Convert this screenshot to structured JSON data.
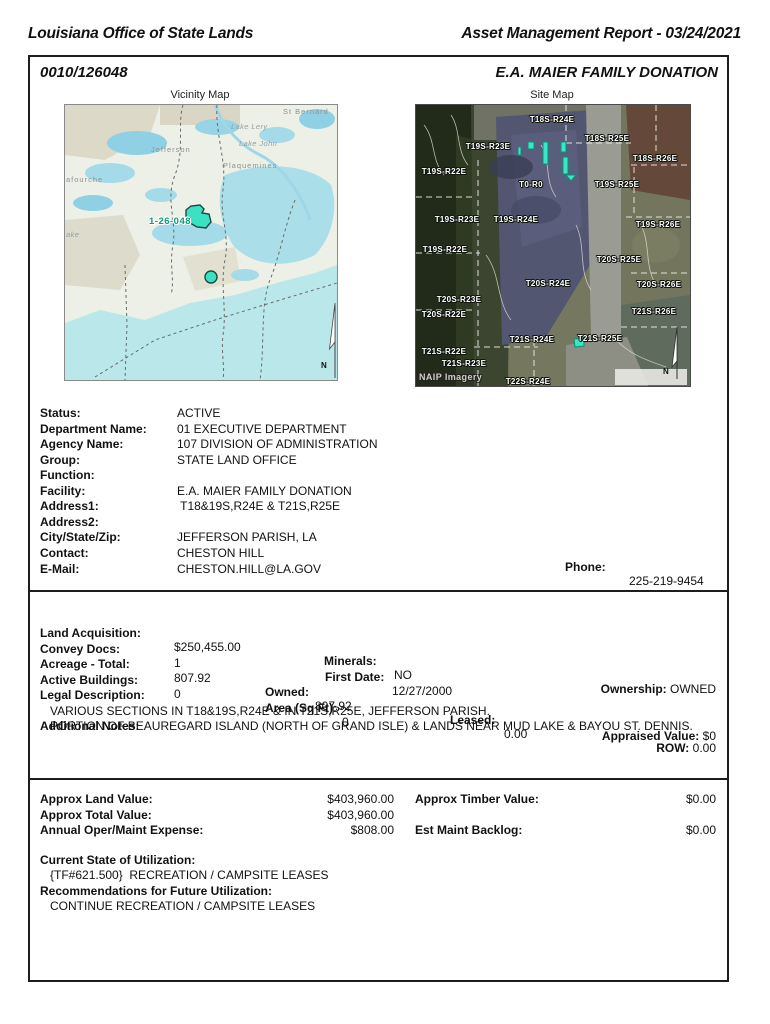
{
  "header": {
    "left": "Louisiana Office of State Lands",
    "right": "Asset Management Report - 03/24/2021"
  },
  "box": {
    "id": "0010/126048",
    "name": "E.A. MAIER FAMILY DONATION"
  },
  "maps": {
    "vicinity": {
      "title": "Vicinity Map",
      "north_label": "N",
      "parcel_label": "1-26-048",
      "parcel_color": "#3ce0c2",
      "labels": [
        {
          "t": "St Bernard",
          "x": 218,
          "y": 2,
          "cls": ""
        },
        {
          "t": "Lake Lery",
          "x": 166,
          "y": 17,
          "cls": "it"
        },
        {
          "t": "Lake John",
          "x": 174,
          "y": 34,
          "cls": "it"
        },
        {
          "t": "Jefferson",
          "x": 86,
          "y": 40,
          "cls": ""
        },
        {
          "t": "Plaquemines",
          "x": 158,
          "y": 56,
          "cls": ""
        },
        {
          "t": "afourche",
          "x": 1,
          "y": 70,
          "cls": ""
        },
        {
          "t": "ake",
          "x": 1,
          "y": 125,
          "cls": "it"
        }
      ]
    },
    "site": {
      "title": "Site Map",
      "credit": "NAIP Imagery",
      "north_label": "N",
      "labels": [
        {
          "t": "T18S-R24E",
          "x": 136,
          "y": 10
        },
        {
          "t": "T18S-R25E",
          "x": 191,
          "y": 29
        },
        {
          "t": "T18S-R26E",
          "x": 239,
          "y": 49
        },
        {
          "t": "T19S-R23E",
          "x": 72,
          "y": 37
        },
        {
          "t": "T19S-R22E",
          "x": 28,
          "y": 62
        },
        {
          "t": "T0-R0",
          "x": 115,
          "y": 75
        },
        {
          "t": "T19S-R25E",
          "x": 201,
          "y": 75
        },
        {
          "t": "T19S-R23E",
          "x": 41,
          "y": 110
        },
        {
          "t": "T19S-R24E",
          "x": 100,
          "y": 110
        },
        {
          "t": "T19S-R26E",
          "x": 242,
          "y": 115
        },
        {
          "t": "T19S-R22E",
          "x": 29,
          "y": 140
        },
        {
          "t": "T20S-R25E",
          "x": 203,
          "y": 150
        },
        {
          "t": "T20S-R24E",
          "x": 132,
          "y": 174
        },
        {
          "t": "T20S-R26E",
          "x": 243,
          "y": 175
        },
        {
          "t": "T20S-R23E",
          "x": 43,
          "y": 190
        },
        {
          "t": "T20S-R22E",
          "x": 28,
          "y": 205
        },
        {
          "t": "T21S-R26E",
          "x": 238,
          "y": 202
        },
        {
          "t": "T21S-R24E",
          "x": 116,
          "y": 230
        },
        {
          "t": "T21S-R25E",
          "x": 184,
          "y": 229
        },
        {
          "t": "T21S-R22E",
          "x": 28,
          "y": 242
        },
        {
          "t": "T21S-R23E",
          "x": 48,
          "y": 254
        },
        {
          "t": "T22S-R24E",
          "x": 112,
          "y": 272
        }
      ]
    }
  },
  "identity": {
    "rows": [
      {
        "label": "Status:",
        "value": "ACTIVE"
      },
      {
        "label": "Department Name:",
        "value": "01 EXECUTIVE DEPARTMENT"
      },
      {
        "label": "Agency Name:",
        "value": "107 DIVISION OF ADMINISTRATION"
      },
      {
        "label": "Group:",
        "value": "STATE LAND OFFICE"
      },
      {
        "label": "Function:",
        "value": ""
      },
      {
        "label": "Facility:",
        "value": "E.A. MAIER FAMILY DONATION"
      },
      {
        "label": "Address1:",
        "value": " T18&19S,R24E & T21S,R25E"
      },
      {
        "label": "Address2:",
        "value": ""
      },
      {
        "label": "City/State/Zip:",
        "value": "JEFFERSON PARISH, LA"
      },
      {
        "label": "Contact:",
        "value": "CHESTON HILL"
      },
      {
        "label": "E-Mail:",
        "value": "CHESTON.HILL@LA.GOV"
      }
    ],
    "phone_label": "Phone:",
    "phone_value": "225-219-9454"
  },
  "acquisition": {
    "land_acq_label": "Land Acquisition:",
    "land_acq_value": "$250,455.00",
    "minerals_label": "Minerals:",
    "minerals_value": "NO",
    "ownership_label": "Ownership:",
    "ownership_value": "OWNED",
    "convey_label": "Convey Docs:",
    "convey_value": "1",
    "first_date_label": "First Date:",
    "first_date_value": "12/27/2000",
    "acreage_label": "Acreage - Total:",
    "acreage_value": "807.92",
    "owned_label": "Owned:",
    "owned_value": "807.92",
    "leased_label": "Leased:",
    "leased_value": "0.00",
    "row_label": "ROW:",
    "row_value": "0.00",
    "buildings_label": "Active Buildings:",
    "buildings_value": "0",
    "area_label": "Area (Sq Ft):",
    "area_value": "0",
    "appraised_label": "Appraised Value:",
    "appraised_value": "$0",
    "legal_label": "Legal Description:",
    "legal_text": "VARIOUS SECTIONS IN T18&19S,R24E & IN T21S,R25E, JEFFERSON PARISH.",
    "notes_label": "Additional Notes:",
    "notes_text": "PORTION OF BEAUREGARD ISLAND (NORTH OF GRAND ISLE) & LANDS NEAR MUD LAKE & BAYOU ST. DENNIS."
  },
  "valuation": {
    "rows": [
      {
        "label": "Approx Land Value:",
        "value": "$403,960.00",
        "label2": "Approx Timber Value:",
        "value2": "$0.00"
      },
      {
        "label": "Approx Total Value:",
        "value": "$403,960.00",
        "label2": "",
        "value2": ""
      },
      {
        "label": "Annual Oper/Maint Expense:",
        "value": "$808.00",
        "label2": "Est Maint Backlog:",
        "value2": "$0.00"
      }
    ],
    "current_label": "Current State of Utilization:",
    "current_text": "{TF#621.500}  RECREATION / CAMPSITE LEASES",
    "future_label": "Recommendations for Future Utilization:",
    "future_text": "CONTINUE RECREATION / CAMPSITE LEASES"
  }
}
